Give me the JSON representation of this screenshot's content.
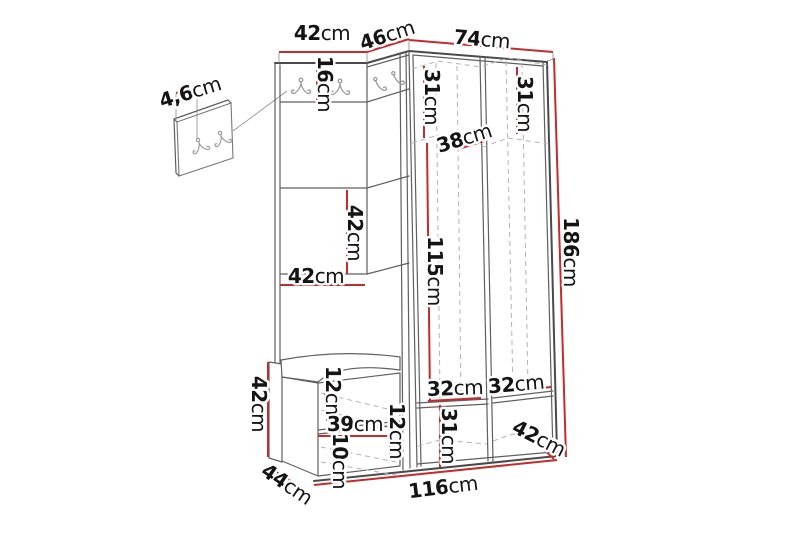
{
  "figure": {
    "kind": "furniture-dimension-diagram",
    "subject": "corner hallway unit with coat hooks, open wardrobe and bench",
    "measurement_unit": "cm"
  },
  "colors": {
    "dimension_line": "#c42b2b",
    "outline": "#5f5f5f",
    "dashed_interior": "#b3b3b3",
    "label_text": "#141414",
    "background": "#ffffff"
  },
  "icons": {
    "double_coat_hook": "double-coat-hook",
    "single_coat_hook": "single-coat-hook"
  },
  "dimensions": {
    "top_section_width": {
      "value": "42",
      "unit": "cm"
    },
    "corner_section_width": {
      "value": "46",
      "unit": "cm"
    },
    "wardrobe_width": {
      "value": "74",
      "unit": "cm"
    },
    "hook_rail_height": {
      "value": "16",
      "unit": "cm"
    },
    "upper_shelf_height_left": {
      "value": "31",
      "unit": "cm"
    },
    "upper_shelf_height_right": {
      "value": "31",
      "unit": "cm"
    },
    "shelf_depth": {
      "value": "38",
      "unit": "cm"
    },
    "total_height": {
      "value": "186",
      "unit": "cm"
    },
    "back_panel_height": {
      "value": "42",
      "unit": "cm"
    },
    "back_panel_width": {
      "value": "42",
      "unit": "cm"
    },
    "open_section_height": {
      "value": "115",
      "unit": "cm"
    },
    "seat_height": {
      "value": "12",
      "unit": "cm"
    },
    "bench_inner_width": {
      "value": "39",
      "unit": "cm"
    },
    "bench_inner_height": {
      "value": "12",
      "unit": "cm"
    },
    "bench_base_height": {
      "value": "10",
      "unit": "cm"
    },
    "bench_side_height": {
      "value": "42",
      "unit": "cm"
    },
    "bench_depth": {
      "value": "44",
      "unit": "cm"
    },
    "total_width": {
      "value": "116",
      "unit": "cm"
    },
    "lower_shelf_width_left": {
      "value": "32",
      "unit": "cm"
    },
    "lower_shelf_width_right": {
      "value": "32",
      "unit": "cm"
    },
    "lower_section_height": {
      "value": "31",
      "unit": "cm"
    },
    "wardrobe_depth": {
      "value": "42",
      "unit": "cm"
    },
    "hook_plate_width": {
      "value": "4,6",
      "unit": "cm"
    }
  }
}
